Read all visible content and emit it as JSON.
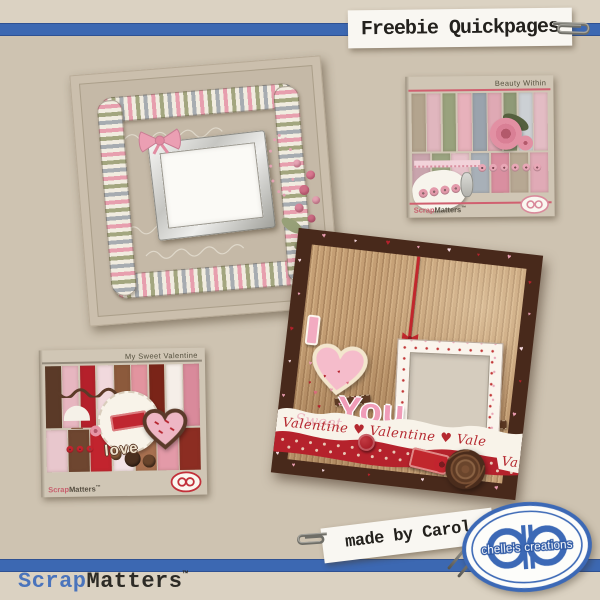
{
  "palette": {
    "background": "#cec3b1",
    "edge_strip": "#dbd2c2",
    "ribbon_blue": "#3c68b2",
    "paper_white": "#f9f7f2",
    "logo_blue": "#3c69b6",
    "brand_blue": "#4a74bc",
    "brand_dark": "#2d2b26",
    "qp1_page": "#c5b9a7",
    "stripe_pink": "#e79fae",
    "stripe_green": "#a3a67f",
    "stripe_gray": "#a7acb1",
    "qp2_border_brown": "#48291b",
    "qp2_corduroy": "#c49e74",
    "valentine_red": "#b5222c",
    "valentine_pink": "#f2b6c9",
    "chocolate": "#5d3a24",
    "heart_colors": [
      "#e89cb0",
      "#b5222c",
      "#f6d9e0",
      "#d96a7d"
    ]
  },
  "header": {
    "title": "Freebie Quickpages"
  },
  "made_by": {
    "text": "made by Carol"
  },
  "brand": {
    "prefix": "Scrap",
    "suffix": "Matters",
    "tm": "™"
  },
  "logo": {
    "text": "chelle's creations"
  },
  "qp2": {
    "letter_i": "I",
    "word_you": "You",
    "banner_text": "Valentine ♥ Valentine ♥ Vale",
    "banner_script": "Sweet",
    "banner_fragment": "Va"
  },
  "preview_bw": {
    "title": "Beauty Within",
    "brand_prefix": "Scrap",
    "brand_suffix": "Matters",
    "brand_tm": "™",
    "papers_top": [
      "#b3a48e",
      "#e0b6be",
      "#99a27d",
      "#e7b1bb",
      "#9aa3ad",
      "#dfa9b4",
      "#8f9a77",
      "#ccd0d4",
      "#e3bcc4"
    ],
    "papers_bottom": [
      "#c9a4ad",
      "#9aa380",
      "#e6c2ca",
      "#a8b0b8",
      "#d98fa0",
      "#b7a893",
      "#e0aab6"
    ]
  },
  "preview_msv": {
    "title": "My Sweet Valentine",
    "brand_prefix": "Scrap",
    "brand_suffix": "Matters",
    "brand_tm": "™",
    "word_art": "love",
    "papers_top": [
      "#5b3a28",
      "#e7b6c0",
      "#b5202b",
      "#f1d9dd",
      "#8c5a3c",
      "#e2949f",
      "#7a2418",
      "#f5eee8",
      "#d98a9b"
    ],
    "papers_bottom": [
      "#e8c7cd",
      "#6e4630",
      "#c2242e",
      "#f3e3e6",
      "#a87050",
      "#e39aa8",
      "#8c2d22"
    ]
  }
}
